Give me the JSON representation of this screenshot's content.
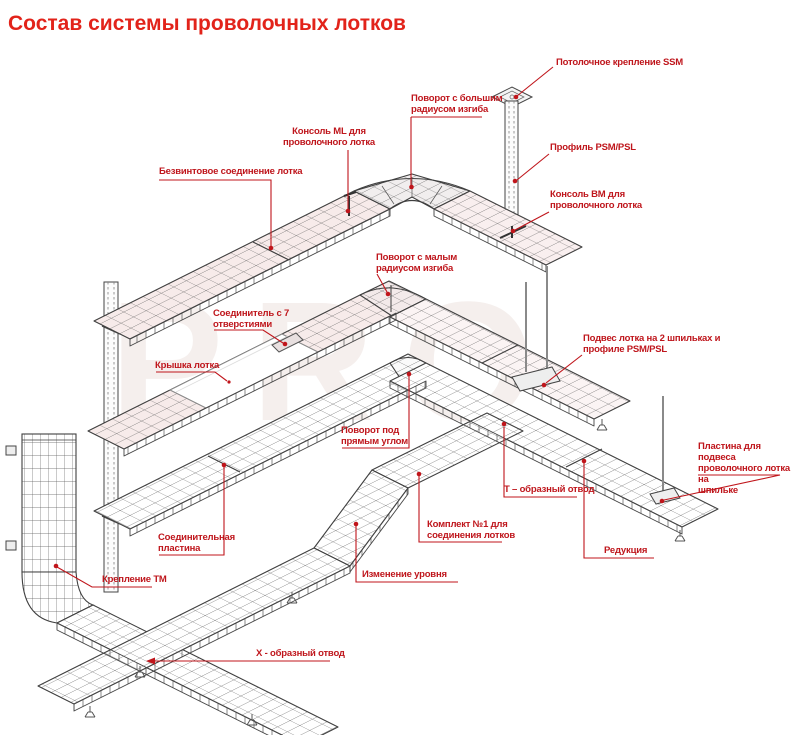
{
  "title": "Состав системы проволочных лотков",
  "watermark": "PRO",
  "labels": {
    "ceiling_mount_ssm": "Потолочное крепление SSM",
    "bend_large_radius": "Поворот с большим\nрадиусом изгиба",
    "console_ml": "Консоль ML для\nпроволочного лотка",
    "screwless_joint": "Безвинтовое соединение лотка",
    "profile_psm_psl": "Профиль PSM/PSL",
    "console_bm": "Консоль BM для\nпроволочного лотка",
    "bend_small_radius": "Поворот с малым\nрадиусом изгиба",
    "connector_7_holes": "Соединитель с 7\nотверстиями",
    "tray_cover": "Крышка лотка",
    "hanger_2_studs": "Подвес лотка на 2 шпильках и\nпрофиле PSM/PSL",
    "right_angle_turn": "Поворот под\nпрямым углом",
    "hanger_plate": "Пластина для подвеса\nпроволочного лотка на\nшпильке",
    "t_branch": "Т – образный отвод",
    "kit_no1": "Комплект №1 для\nсоединения лотков",
    "reduction": "Редукция",
    "level_change": "Изменение уровня",
    "joint_plate": "Соединительная\nпластина",
    "mount_tm": "Крепление ТМ",
    "x_branch": "X - образный отвод"
  }
}
